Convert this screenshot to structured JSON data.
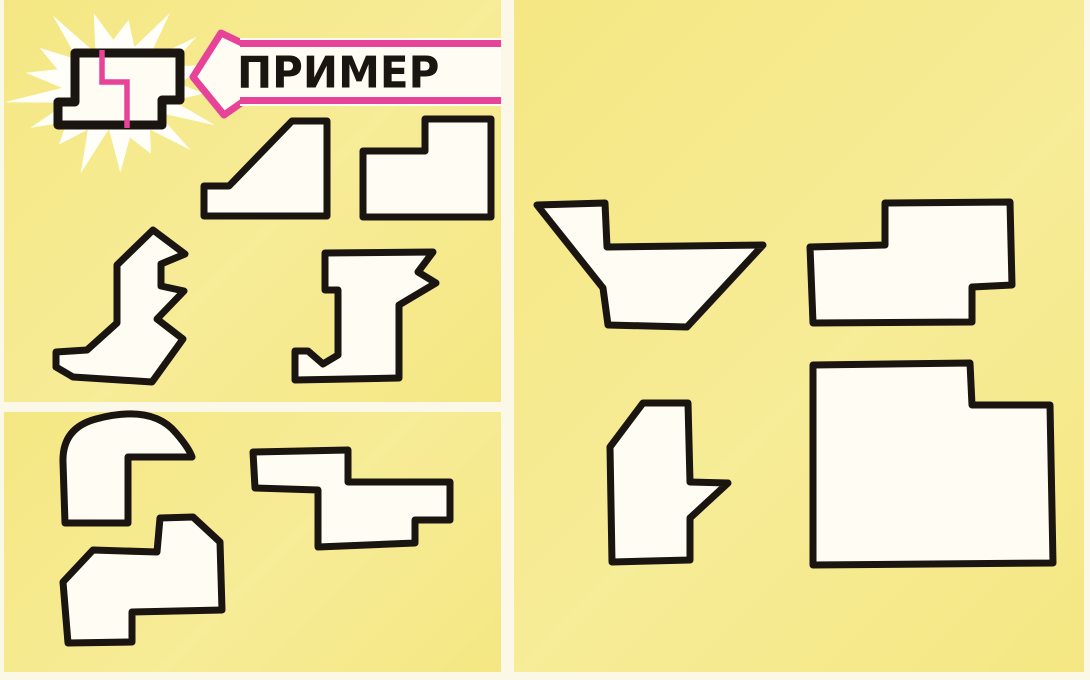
{
  "colors": {
    "paper": "#fbf8e7",
    "panel": "#f4e783",
    "panel_light": "#f7ec97",
    "ink": "#1a1510",
    "pink": "#e64399",
    "fill": "#fffdf3",
    "burst_white": "#fffef8"
  },
  "arrow": {
    "label": "ПРИМЕР"
  },
  "example": {
    "outline": "M75,53 L180,53 L180,100 L162,100 L162,125 L58,125 L58,102 L75,102 Z",
    "seam": "M102,50 L102,82 L127,82 L127,128",
    "burst": {
      "cx": 116,
      "cy": 90,
      "spikes": 17,
      "rx_outer": 100,
      "ry_outer": 80,
      "rx_inner": 57,
      "ry_inner": 45
    }
  },
  "pieces": [
    {
      "id": "ramp",
      "d": "M292,121 L327,121 L327,216 L204,216 L204,186 L229,186 Z"
    },
    {
      "id": "step-block-top",
      "d": "M425,119 L491,119 L491,217 L363,217 L363,151 L425,151 Z"
    },
    {
      "id": "spiked-boot",
      "d": "M153,230 L185,254 L161,264 L161,286 L184,291 L157,319 L183,339 L152,382 L73,377 L56,367 L56,352 L87,350 L117,323 L117,265 Z"
    },
    {
      "id": "j-block",
      "d": "M325,253 L433,252 L418,272 L436,283 L399,305 L399,378 L295,380 L295,351 L308,351 L323,364 L338,355 L338,290 L325,290 Z"
    },
    {
      "id": "wave-hook",
      "d": "M65,523 L63,462 Q62,428 96,419 Q152,404 176,433 Q189,448 192,457 L128,457 L128,523 Z"
    },
    {
      "id": "z-block",
      "d": "M253,452 L348,450 L348,482 L450,482 L450,520 L415,520 L415,543 L318,547 L318,490 L255,488 Z"
    },
    {
      "id": "boot",
      "d": "M160,518 L193,517 L220,542 L222,610 L132,612 L132,642 L68,643 L63,582 L93,550 L157,552 Z"
    },
    {
      "id": "check-flag",
      "d": "M537,205 L605,203 L607,247 L763,245 L687,327 L608,325 L603,288 Z"
    },
    {
      "id": "step-block-right",
      "d": "M885,203 L1010,202 L1012,285 L972,287 L972,322 L813,323 L810,247 L885,245 Z"
    },
    {
      "id": "notched-column",
      "d": "M643,403 L688,403 L690,482 L728,483 L690,518 L690,560 L612,562 L610,447 Z"
    },
    {
      "id": "big-block",
      "d": "M813,365 L970,363 L972,405 L1050,405 L1053,563 L813,565 Z"
    }
  ]
}
